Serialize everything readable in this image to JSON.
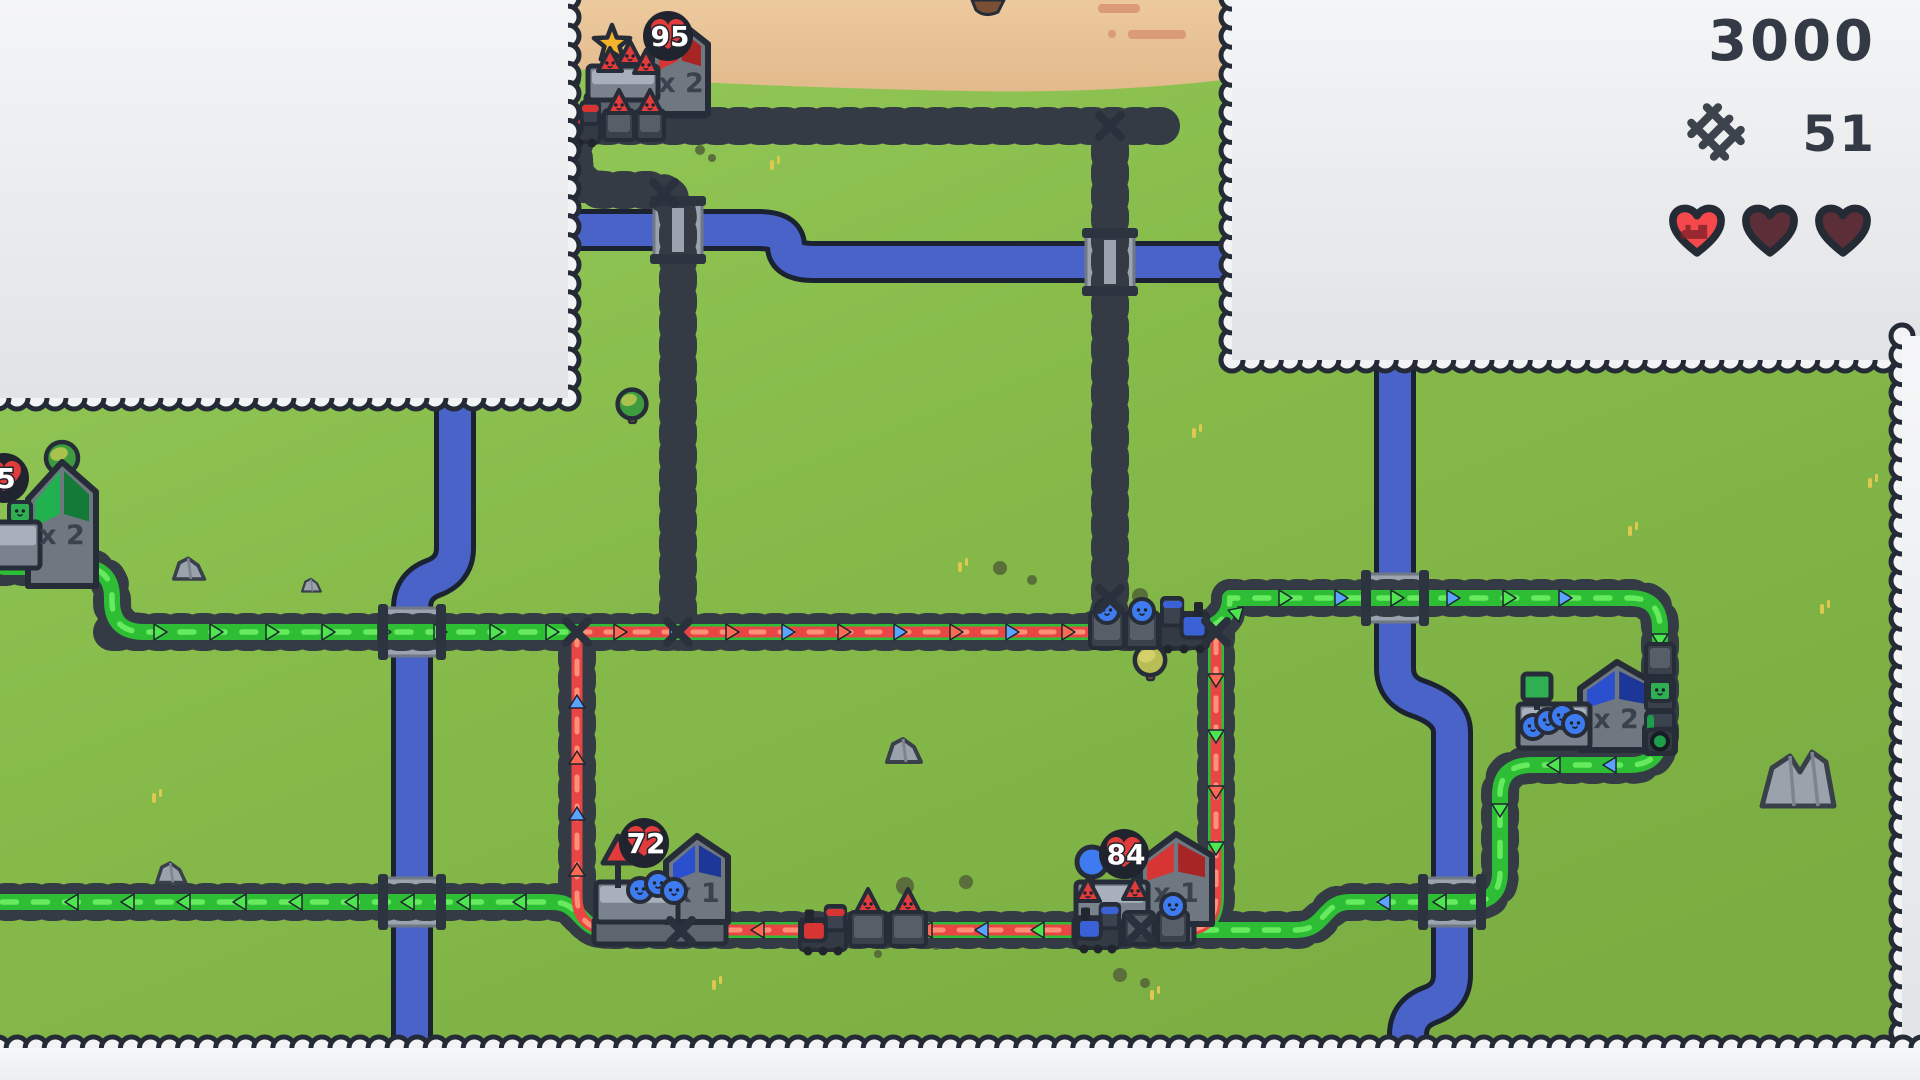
{
  "hud": {
    "money": "3000",
    "rails": "51",
    "lives": [
      {
        "full": true
      },
      {
        "full": false
      },
      {
        "full": false
      }
    ]
  },
  "stations": [
    {
      "id": "north",
      "badge": "95",
      "sign": "star",
      "multiplier": "x 2",
      "building_color": "red",
      "waiting": [
        "triangle",
        "triangle",
        "triangle"
      ]
    },
    {
      "id": "west",
      "badge": "5",
      "sign": null,
      "multiplier": "x 2",
      "building_color": "green",
      "waiting": [
        "square"
      ]
    },
    {
      "id": "south",
      "badge": "72",
      "sign": "triangle",
      "multiplier": "x 1",
      "building_color": "blue",
      "waiting": [
        "circle",
        "circle",
        "circle"
      ]
    },
    {
      "id": "southeast",
      "badge": "84",
      "sign": "circle",
      "multiplier": "x 1",
      "building_color": "red",
      "waiting": [
        "triangle",
        "circle",
        "triangle"
      ]
    },
    {
      "id": "east",
      "badge": null,
      "sign": "square",
      "multiplier": "x 2",
      "building_color": "blue",
      "waiting": [
        "circle",
        "circle",
        "circle",
        "circle"
      ]
    }
  ],
  "trains": [
    {
      "id": "train-red-north",
      "color": "red",
      "cargo": [
        "triangle",
        "triangle"
      ]
    },
    {
      "id": "train-blue-main",
      "color": "blue",
      "cargo": [
        "circle",
        "circle"
      ]
    },
    {
      "id": "train-red-south",
      "color": "red",
      "cargo": [
        "triangle",
        "triangle"
      ]
    },
    {
      "id": "train-blue-station",
      "color": "blue",
      "cargo": [
        null,
        "circle"
      ]
    },
    {
      "id": "train-green-east",
      "color": "green",
      "cargo": [
        null,
        "square"
      ]
    }
  ],
  "colors": {
    "outline": "#262d38",
    "grass": "#8ac24d",
    "sand": "#e9c69c",
    "river": "#4a63c8",
    "river_outline": "#1b2232",
    "cloud": "#f2f3f4",
    "track": "#343b45",
    "deck": "#9aa3ae",
    "deck_cap": "#2c3440",
    "route_green": "#2ebe35",
    "route_green_light": "#66ea5e",
    "route_red": "#e84545",
    "route_red_light": "#ff9078",
    "chevron_blue": "#5aa4ff",
    "chevron_green": "#4fe54f",
    "chevron_red": "#ff6a52",
    "hud_text": "#333a45",
    "heart_full": "#f4484d",
    "heart_empty": "#5c2e38",
    "badge_bg": "#20242e",
    "badge_heart": "#e23b3b",
    "pax_red": "#e33b3b",
    "pax_blue": "#3f7bf0",
    "pax_green": "#2fae52",
    "roof_red": "#d73434",
    "roof_red2": "#a82525",
    "roof_green": "#21b14e",
    "roof_green2": "#147a38",
    "roof_blue": "#2b50cf",
    "roof_blue2": "#1d3798",
    "bldg_body": "#6f7781",
    "platform": "#79828d",
    "platform_top": "#a8b1bb",
    "platform_base": "#5d656f",
    "star": "#f3b32b",
    "engine_red": "#d73434",
    "engine_blue": "#3a62d6",
    "engine_green": "#1e9e4a"
  }
}
